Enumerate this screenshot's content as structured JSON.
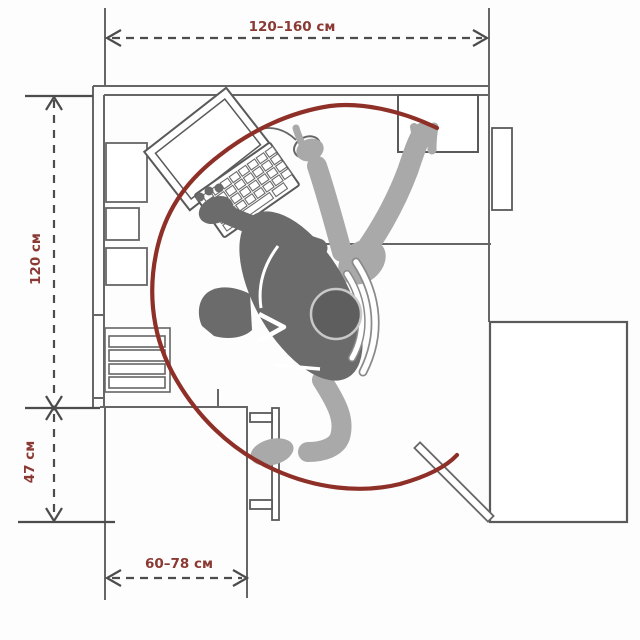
{
  "diagram": {
    "type": "workspace-ergonomics-floor-plan",
    "dimensions": {
      "top": "120–160 см",
      "left_upper": "120 см",
      "left_lower": "47 см",
      "bottom": "60–78 см"
    },
    "colors": {
      "dimension_text": "#8b3a33",
      "dimension_line": "#4c4c4c",
      "outline": "#666666",
      "reach_arc": "#8e2f28",
      "figure_dark": "#6b6b6b",
      "figure_light": "#a9a9a9",
      "chair_outline": "#8a8a8a"
    }
  }
}
